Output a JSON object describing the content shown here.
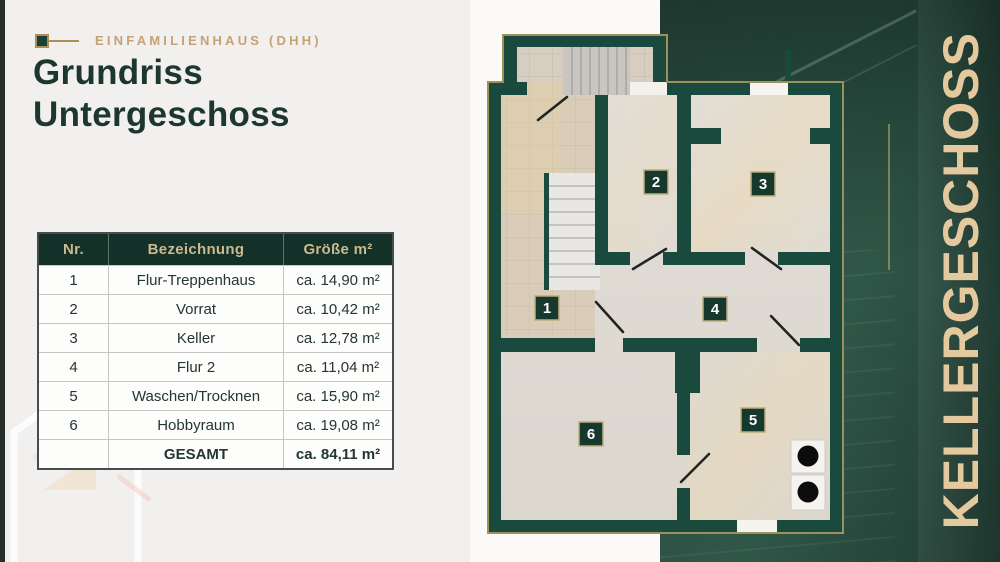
{
  "header": {
    "eyebrow": "EINFAMILIENHAUS (DHH)",
    "title_line1": "Grundriss",
    "title_line2": "Untergeschoss"
  },
  "table": {
    "col_nr": "Nr.",
    "col_name": "Bezeichnung",
    "col_size": "Größe m²",
    "rows": [
      {
        "nr": "1",
        "name": "Flur-Treppenhaus",
        "size": "ca. 14,90 m²"
      },
      {
        "nr": "2",
        "name": "Vorrat",
        "size": "ca. 10,42 m²"
      },
      {
        "nr": "3",
        "name": "Keller",
        "size": "ca. 12,78 m²"
      },
      {
        "nr": "4",
        "name": "Flur 2",
        "size": "ca. 11,04 m²"
      },
      {
        "nr": "5",
        "name": "Waschen/Trocknen",
        "size": "ca. 15,90 m²"
      },
      {
        "nr": "6",
        "name": "Hobbyraum",
        "size": "ca. 19,08 m²"
      }
    ],
    "total_label": "GESAMT",
    "total_size": "ca. 84,11 m²"
  },
  "floorplan": {
    "room_numbers": [
      "1",
      "2",
      "3",
      "4",
      "5",
      "6"
    ],
    "wall_color": "#194a3d",
    "badge_border_color": "#bfae7e"
  },
  "panel": {
    "vertical_label": "KELLERGESCHOSS",
    "text_color": "#e5c99e"
  }
}
